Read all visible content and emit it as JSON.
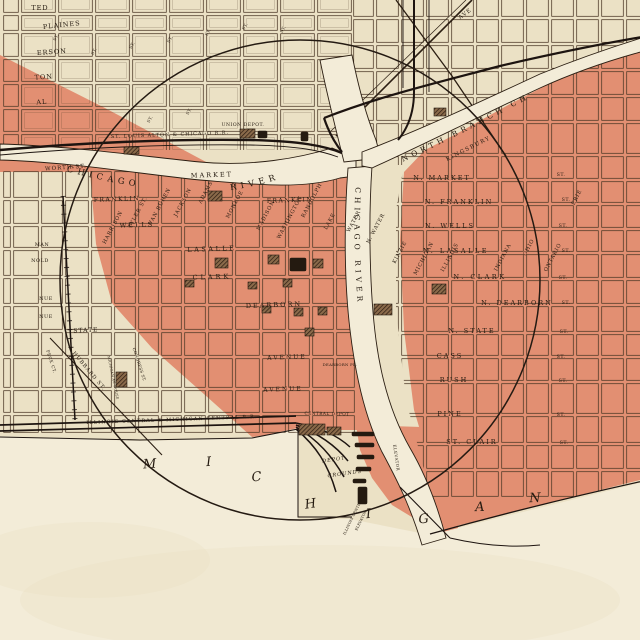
{
  "map_colors": {
    "paper": "#ebe1c5",
    "burnt_district": "#e28f72",
    "water_paper": "#f3ecd8",
    "ink": "#2b1e12"
  },
  "lake_label": "MICHIGAN",
  "street_abbrev": "ST.",
  "rivers": {
    "south_branch_word1": "CHICAGO",
    "south_branch_word2": "RIVER",
    "main_stem": "CHICAGO RIVER",
    "north_branch": "NORTH BRANCH CH"
  },
  "labels": {
    "w1": "TED",
    "w2": "PLAINES",
    "w3": "ERSON",
    "w4": "TON",
    "w5": "AL",
    "w6": "WORTH ST.",
    "w7": "MAN",
    "w8": "NOLD",
    "w9": "NUE",
    "w10": "NUE",
    "w11": "STATE",
    "w12": "PECK CT.",
    "w13": "HUBBARD ST.",
    "w14": "MICHIGAN AV. HOUSE",
    "w15": "CONGRESS ST.",
    "c1": "MARKET",
    "c2": "FRANKLIN",
    "c3": "FRANKLIN",
    "c4": "WELLS",
    "c5": "LASALLE",
    "c6": "CLARK",
    "c7": "DEARBORN",
    "c8": "AVENUE",
    "c9": "AVENUE",
    "c10": "DEARBORN PL.",
    "d1": "HARRISON",
    "d2": "TYLER ST.",
    "d3": "VAN BUREN",
    "d4": "JACKSON",
    "d5": "ADAMS",
    "d6": "MONROE",
    "d7": "MADISON",
    "d8": "WASHINGTON",
    "d9": "RANDOLPH",
    "n1": "N. MARKET",
    "n2": "N. FRANKLIN",
    "n3": "N. WELLS",
    "n4": "N. LASALLE",
    "n5": "N. CLARK",
    "n6": "N. DEARBORN",
    "n7": "N. STATE",
    "n8": "CASS",
    "n9": "RUSH",
    "n10": "PINE",
    "n11": "ST. CLAIR",
    "e1": "LAKE",
    "e2": "WATER",
    "e3": "N. WATER",
    "e4": "KINZIE",
    "e5": "MICHIGAN",
    "e6": "ILLINOIS",
    "e7": "INDIANA",
    "e8": "OHIO",
    "e9": "ONTARIO",
    "e10": "ERIE",
    "e11": "KINGSBURY",
    "r1": "ST. LOUIS ALTON & CHICAGO R.R.",
    "r2": "UNION DEPOT.",
    "r3": "ILLINOIS CENTRAL & MICHIGAN CENTRAL R.R.",
    "r4": "CENTRAL DEPOT",
    "r5": "DEPOT",
    "r6": "GROUNDS",
    "r7": "ILLINOIS CENTRAL",
    "r8": "ELEVATOR",
    "r9": "ELEVATOR",
    "r10": "AVE"
  }
}
